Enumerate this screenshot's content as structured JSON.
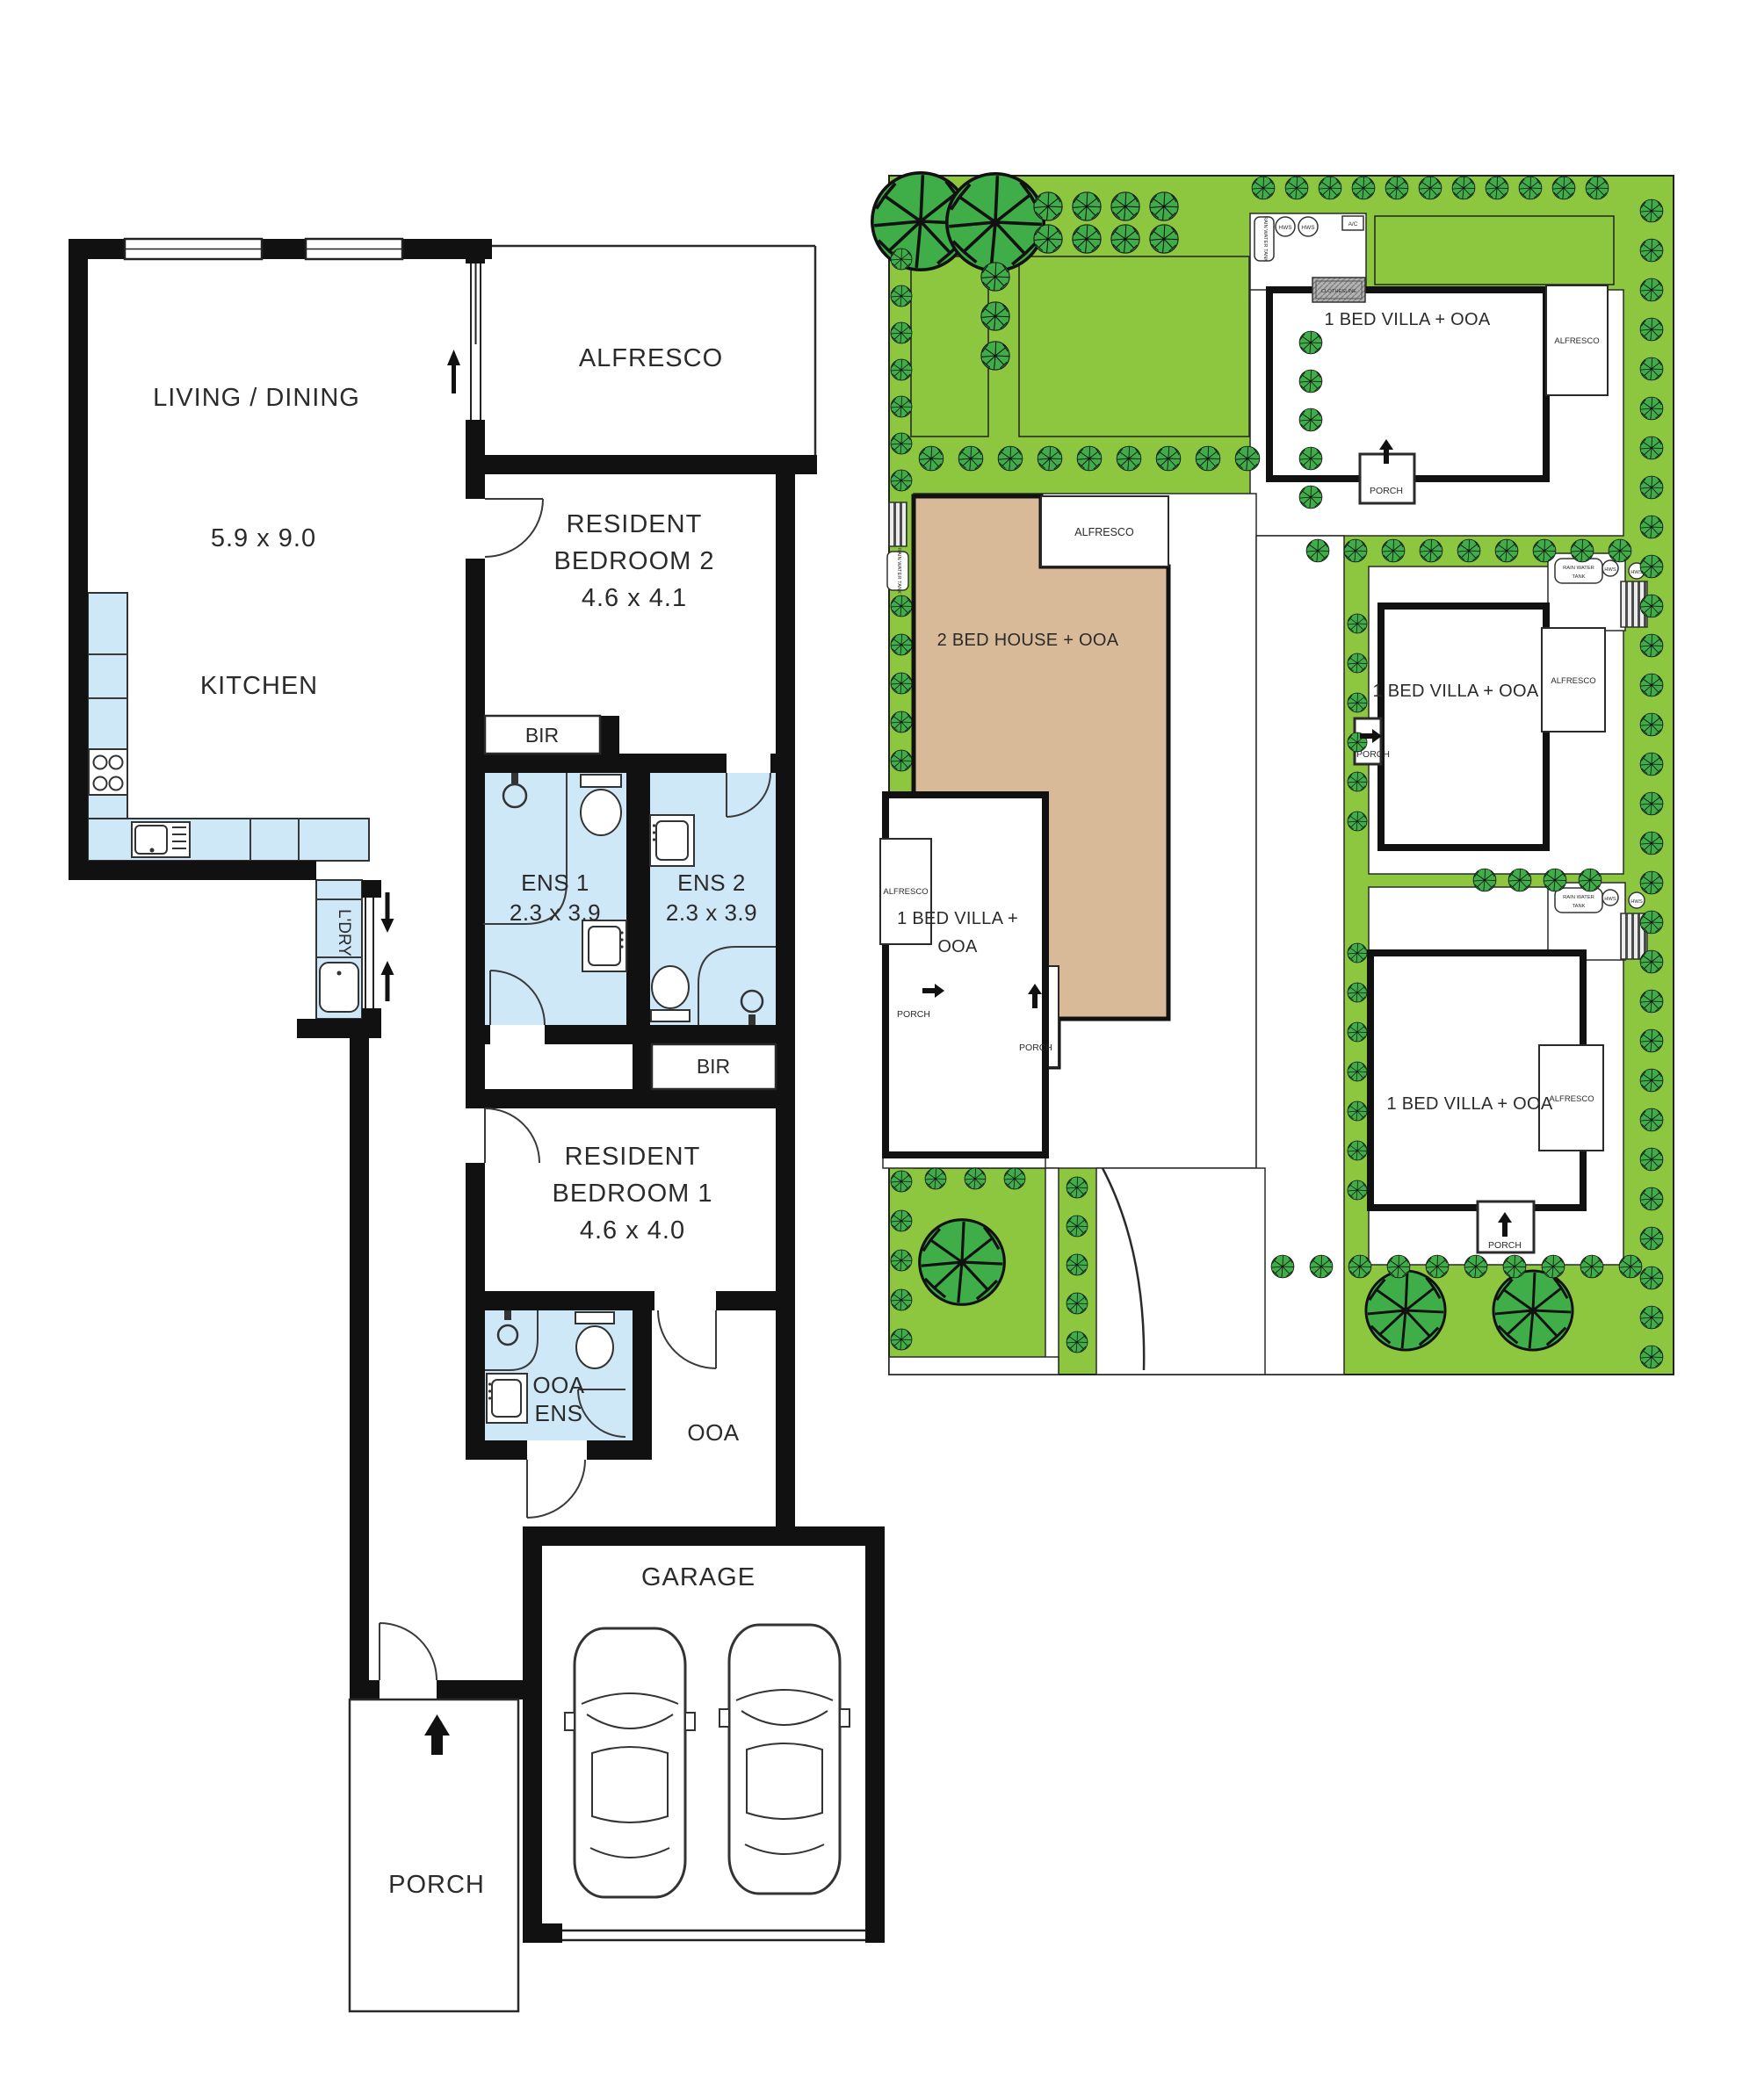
{
  "colors": {
    "wall": "#111111",
    "wet_area": "#cfe8f8",
    "site_green": "#8dc63f",
    "tree_green": "#3fae49",
    "house_tan": "#d8b998",
    "clothesline_gray": "#b3b3b3"
  },
  "floorplan": {
    "living": {
      "name": "LIVING / DINING",
      "dims": "5.9 x 9.0"
    },
    "kitchen": {
      "name": "KITCHEN"
    },
    "alfresco": {
      "name": "ALFRESCO"
    },
    "bedroom2": {
      "line1": "RESIDENT",
      "line2": "BEDROOM 2",
      "dims": "4.6 x 4.1"
    },
    "bedroom1": {
      "line1": "RESIDENT",
      "line2": "BEDROOM 1",
      "dims": "4.6 x 4.0"
    },
    "ens1": {
      "name": "ENS 1",
      "dims": "2.3 x 3.9"
    },
    "ens2": {
      "name": "ENS 2",
      "dims": "2.3 x 3.9"
    },
    "bir": {
      "name": "BIR"
    },
    "laundry": {
      "name": "L'DRY"
    },
    "ooa_ens": {
      "line1": "OOA",
      "line2": "ENS"
    },
    "ooa": {
      "name": "OOA"
    },
    "garage": {
      "name": "GARAGE"
    },
    "porch": {
      "name": "PORCH"
    }
  },
  "siteplan": {
    "villa1": {
      "name": "1 BED VILLA + OOA"
    },
    "villa2": {
      "name": "1 BED VILLA + OOA"
    },
    "villa3": {
      "name": "1 BED VILLA + OOA"
    },
    "villa4": {
      "line1": "1 BED VILLA  +",
      "line2": "OOA"
    },
    "house": {
      "name": "2 BED HOUSE + OOA"
    },
    "labels": {
      "alfresco": "ALFRESCO",
      "porch": "PORCH",
      "rain_water_tank": "RAIN WATER TANK",
      "rain_water_tank_line1": "RAIN WATER",
      "rain_water_tank_line2": "TANK",
      "hws": "HWS",
      "ac": "A/C",
      "clothesline": "CLOTHESLINE"
    }
  }
}
